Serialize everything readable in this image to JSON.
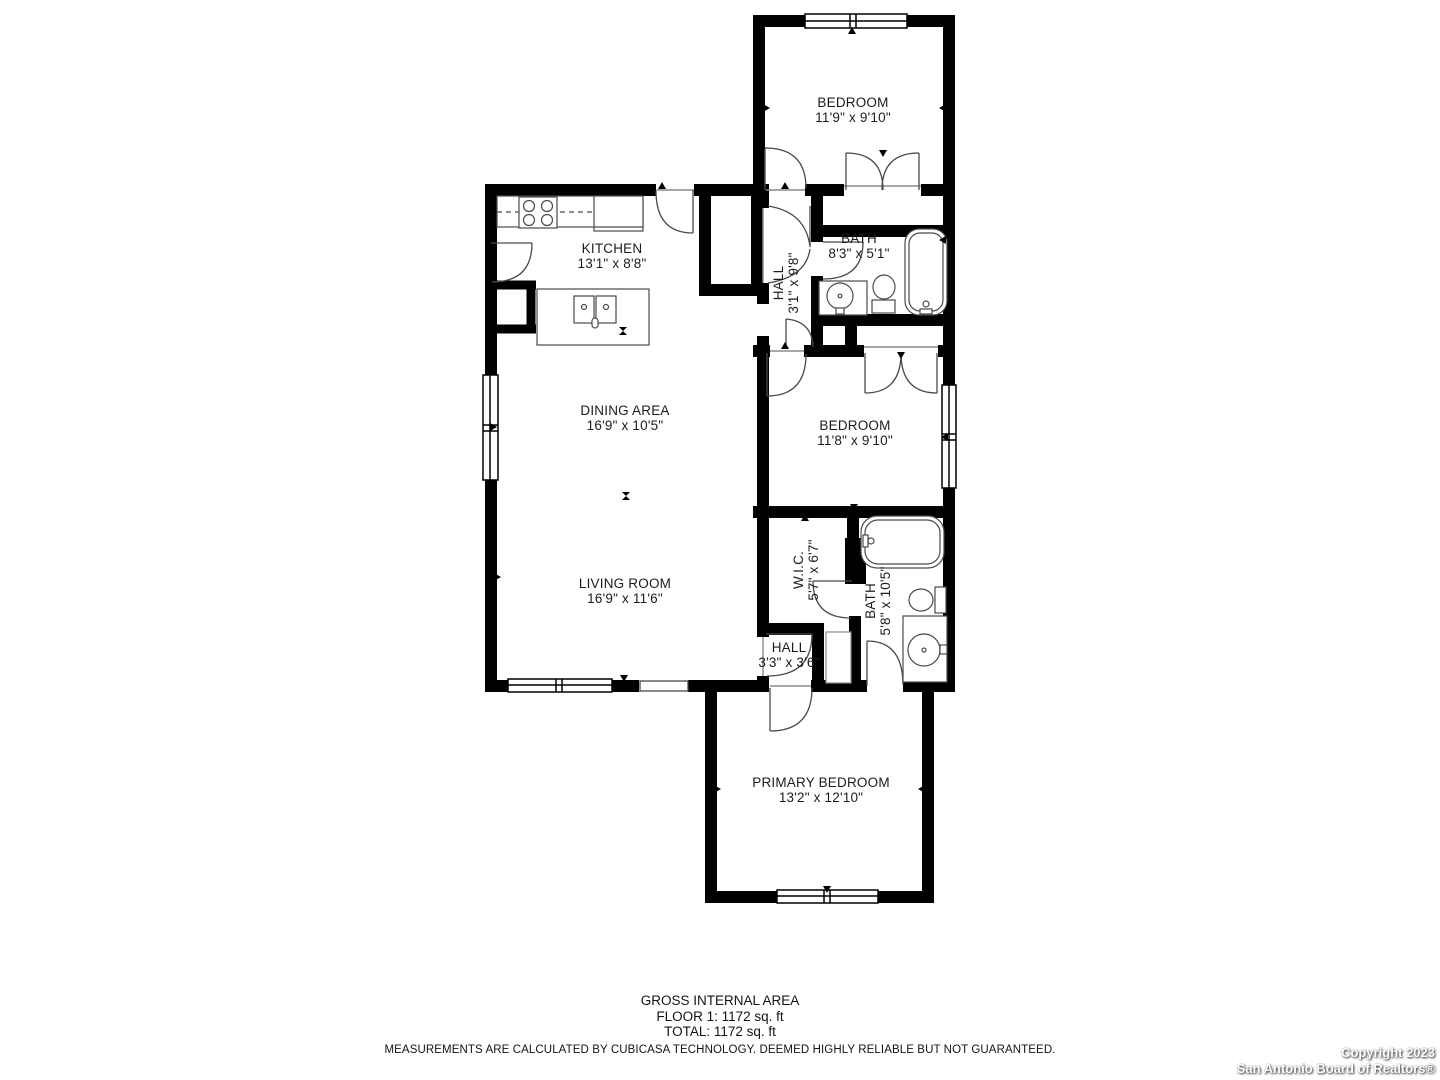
{
  "rooms": [
    {
      "id": "bedroom-top",
      "name": "BEDROOM",
      "dims": "11'9\" x 9'10\""
    },
    {
      "id": "kitchen",
      "name": "KITCHEN",
      "dims": "13'1\" x 8'8\""
    },
    {
      "id": "bath-top",
      "name": "BATH",
      "dims": "8'3\" x 5'1\""
    },
    {
      "id": "hall-top",
      "name": "HALL",
      "dims": "3'1\" x 9'8\""
    },
    {
      "id": "dining",
      "name": "DINING AREA",
      "dims": "16'9\" x 10'5\""
    },
    {
      "id": "bedroom-middle",
      "name": "BEDROOM",
      "dims": "11'8\" x 9'10\""
    },
    {
      "id": "wic",
      "name": "W.I.C.",
      "dims": "5'7\" x 6'7\""
    },
    {
      "id": "bath-bottom",
      "name": "BATH",
      "dims": "5'8\" x 10'5\""
    },
    {
      "id": "living",
      "name": "LIVING ROOM",
      "dims": "16'9\" x 11'6\""
    },
    {
      "id": "hall-bottom",
      "name": "HALL",
      "dims": "3'3\" x 3'6\""
    },
    {
      "id": "primary-bedroom",
      "name": "PRIMARY BEDROOM",
      "dims": "13'2\" x 12'10\""
    }
  ],
  "summary": {
    "title": "GROSS INTERNAL AREA",
    "floor_line": "FLOOR 1: 1172 sq. ft",
    "total_line": "TOTAL: 1172 sq. ft",
    "disclaimer": "MEASUREMENTS ARE CALCULATED BY CUBICASA TECHNOLOGY. DEEMED HIGHLY RELIABLE BUT NOT GUARANTEED."
  },
  "watermark": {
    "line1": "Copyright 2023",
    "line2": "San Antonio Board of Realtors®"
  },
  "colors": {
    "wall": "#000000",
    "fixture_stroke": "#4a4a4a",
    "text": "#1c1c1c",
    "background": "#ffffff"
  }
}
